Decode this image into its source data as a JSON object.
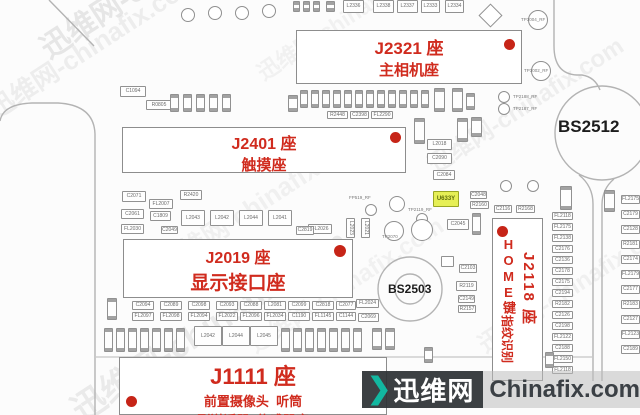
{
  "board": {
    "accent_red": "#d02b1e",
    "highlight_color": "#e6ef56",
    "connectors": {
      "j2321": {
        "title": "J2321 座",
        "subtitle": "主相机座"
      },
      "j2401": {
        "title": "J2401 座",
        "subtitle": "触摸座"
      },
      "j2019": {
        "title": "J2019 座",
        "subtitle": "显示接口座"
      },
      "j1111": {
        "title": "J1111 座",
        "line1": "前置摄像头  听筒",
        "line2": "副送话器  传感器座"
      },
      "j2118": {
        "title": "J2118 座",
        "home": "HOME键",
        "fingerprint": "指纹识别"
      }
    },
    "screws": {
      "bs2512": "BS2512",
      "bs2503": "BS2503"
    },
    "components": [
      {
        "l": "",
        "x": 293,
        "y": 1,
        "w": 7,
        "h": 11,
        "v": 1
      },
      {
        "l": "",
        "x": 303,
        "y": 1,
        "w": 7,
        "h": 11,
        "v": 1
      },
      {
        "l": "",
        "x": 313,
        "y": 1,
        "w": 7,
        "h": 11,
        "v": 1
      },
      {
        "l": "",
        "x": 326,
        "y": 1,
        "w": 9,
        "h": 11,
        "v": 1
      },
      {
        "l": "L2336",
        "x": 343,
        "y": 0,
        "w": 21,
        "h": 13
      },
      {
        "l": "L2338",
        "x": 373,
        "y": 0,
        "w": 21,
        "h": 13
      },
      {
        "l": "L2337",
        "x": 397,
        "y": 0,
        "w": 21,
        "h": 13
      },
      {
        "l": "L2333",
        "x": 421,
        "y": 0,
        "w": 19,
        "h": 13
      },
      {
        "l": "L2334",
        "x": 445,
        "y": 0,
        "w": 19,
        "h": 13
      },
      {
        "l": "C1094",
        "x": 120,
        "y": 86,
        "w": 26,
        "h": 11
      },
      {
        "l": "R0805",
        "x": 146,
        "y": 100,
        "w": 26,
        "h": 10
      },
      {
        "l": "",
        "x": 170,
        "y": 94,
        "w": 9,
        "h": 18,
        "v": 1
      },
      {
        "l": "",
        "x": 183,
        "y": 94,
        "w": 9,
        "h": 18,
        "v": 1
      },
      {
        "l": "",
        "x": 196,
        "y": 94,
        "w": 9,
        "h": 18,
        "v": 1
      },
      {
        "l": "",
        "x": 209,
        "y": 94,
        "w": 9,
        "h": 18,
        "v": 1
      },
      {
        "l": "",
        "x": 222,
        "y": 94,
        "w": 9,
        "h": 18,
        "v": 1
      },
      {
        "l": "",
        "x": 288,
        "y": 95,
        "w": 10,
        "h": 17,
        "v": 1
      },
      {
        "l": "",
        "x": 300,
        "y": 90,
        "w": 8,
        "h": 18,
        "v": 1
      },
      {
        "l": "",
        "x": 311,
        "y": 90,
        "w": 8,
        "h": 18,
        "v": 1
      },
      {
        "l": "",
        "x": 322,
        "y": 90,
        "w": 8,
        "h": 18,
        "v": 1
      },
      {
        "l": "",
        "x": 333,
        "y": 90,
        "w": 8,
        "h": 18,
        "v": 1
      },
      {
        "l": "",
        "x": 344,
        "y": 90,
        "w": 8,
        "h": 18,
        "v": 1
      },
      {
        "l": "",
        "x": 355,
        "y": 90,
        "w": 8,
        "h": 18,
        "v": 1
      },
      {
        "l": "",
        "x": 366,
        "y": 90,
        "w": 8,
        "h": 18,
        "v": 1
      },
      {
        "l": "",
        "x": 377,
        "y": 90,
        "w": 8,
        "h": 18,
        "v": 1
      },
      {
        "l": "",
        "x": 388,
        "y": 90,
        "w": 8,
        "h": 18,
        "v": 1
      },
      {
        "l": "",
        "x": 399,
        "y": 90,
        "w": 8,
        "h": 18,
        "v": 1
      },
      {
        "l": "",
        "x": 410,
        "y": 90,
        "w": 8,
        "h": 18,
        "v": 1
      },
      {
        "l": "",
        "x": 421,
        "y": 90,
        "w": 8,
        "h": 18,
        "v": 1
      },
      {
        "l": "",
        "x": 434,
        "y": 88,
        "w": 11,
        "h": 24,
        "v": 1
      },
      {
        "l": "",
        "x": 452,
        "y": 88,
        "w": 11,
        "h": 24,
        "v": 1
      },
      {
        "l": "",
        "x": 466,
        "y": 93,
        "w": 9,
        "h": 17,
        "v": 1
      },
      {
        "l": "R2448",
        "x": 327,
        "y": 111,
        "w": 21,
        "h": 8
      },
      {
        "l": "C2398",
        "x": 350,
        "y": 111,
        "w": 19,
        "h": 8
      },
      {
        "l": "FL2290",
        "x": 371,
        "y": 111,
        "w": 22,
        "h": 8
      },
      {
        "l": "",
        "x": 414,
        "y": 118,
        "w": 11,
        "h": 26,
        "v": 1
      },
      {
        "l": "",
        "x": 457,
        "y": 118,
        "w": 11,
        "h": 24,
        "v": 1
      },
      {
        "l": "",
        "x": 471,
        "y": 117,
        "w": 11,
        "h": 20,
        "v": 1
      },
      {
        "l": "L2018",
        "x": 427,
        "y": 139,
        "w": 25,
        "h": 11
      },
      {
        "l": "C2090",
        "x": 427,
        "y": 153,
        "w": 25,
        "h": 11
      },
      {
        "l": "C2084",
        "x": 433,
        "y": 170,
        "w": 22,
        "h": 10
      },
      {
        "l": "U633Y",
        "x": 433,
        "y": 191,
        "w": 26,
        "h": 16,
        "hl": 1
      },
      {
        "l": "C2045",
        "x": 447,
        "y": 219,
        "w": 22,
        "h": 11
      },
      {
        "l": "",
        "x": 472,
        "y": 213,
        "w": 9,
        "h": 22,
        "v": 1
      },
      {
        "l": "C2048",
        "x": 470,
        "y": 191,
        "w": 17,
        "h": 8
      },
      {
        "l": "R2160",
        "x": 470,
        "y": 201,
        "w": 19,
        "h": 8
      },
      {
        "l": "C2116",
        "x": 494,
        "y": 205,
        "w": 18,
        "h": 8
      },
      {
        "l": "R2168",
        "x": 516,
        "y": 205,
        "w": 19,
        "h": 8
      },
      {
        "l": "C2103",
        "x": 459,
        "y": 264,
        "w": 18,
        "h": 9
      },
      {
        "l": "R2119",
        "x": 456,
        "y": 281,
        "w": 21,
        "h": 10
      },
      {
        "l": "C2149",
        "x": 458,
        "y": 295,
        "w": 17,
        "h": 8
      },
      {
        "l": "R2157",
        "x": 458,
        "y": 305,
        "w": 18,
        "h": 8
      },
      {
        "l": "",
        "x": 441,
        "y": 256,
        "w": 13,
        "h": 11
      },
      {
        "l": "FL2026",
        "x": 308,
        "y": 224,
        "w": 24,
        "h": 10
      },
      {
        "l": "L2023",
        "x": 346,
        "y": 218,
        "w": 9,
        "h": 20,
        "v": 1
      },
      {
        "l": "L2021",
        "x": 361,
        "y": 218,
        "w": 9,
        "h": 20,
        "v": 1
      },
      {
        "l": "C2071",
        "x": 122,
        "y": 191,
        "w": 24,
        "h": 11
      },
      {
        "l": "R2420",
        "x": 180,
        "y": 190,
        "w": 22,
        "h": 10
      },
      {
        "l": "FL2007",
        "x": 149,
        "y": 199,
        "w": 24,
        "h": 10
      },
      {
        "l": "C2061",
        "x": 121,
        "y": 209,
        "w": 23,
        "h": 10
      },
      {
        "l": "C1809",
        "x": 150,
        "y": 211,
        "w": 21,
        "h": 10
      },
      {
        "l": "FL2030",
        "x": 121,
        "y": 224,
        "w": 23,
        "h": 10
      },
      {
        "l": "C2049",
        "x": 161,
        "y": 226,
        "w": 17,
        "h": 8
      },
      {
        "l": "L2043",
        "x": 181,
        "y": 210,
        "w": 24,
        "h": 16
      },
      {
        "l": "L2042",
        "x": 210,
        "y": 210,
        "w": 24,
        "h": 16
      },
      {
        "l": "L2044",
        "x": 239,
        "y": 210,
        "w": 24,
        "h": 16
      },
      {
        "l": "L2041",
        "x": 268,
        "y": 210,
        "w": 24,
        "h": 16
      },
      {
        "l": "C2819",
        "x": 296,
        "y": 226,
        "w": 18,
        "h": 9
      },
      {
        "l": "FL2118",
        "x": 552,
        "y": 212,
        "w": 21,
        "h": 8
      },
      {
        "l": "FL2175",
        "x": 552,
        "y": 223,
        "w": 21,
        "h": 8
      },
      {
        "l": "FL2138",
        "x": 552,
        "y": 234,
        "w": 21,
        "h": 8
      },
      {
        "l": "C2176",
        "x": 552,
        "y": 245,
        "w": 21,
        "h": 8
      },
      {
        "l": "C2136",
        "x": 552,
        "y": 256,
        "w": 21,
        "h": 8
      },
      {
        "l": "C2178",
        "x": 552,
        "y": 267,
        "w": 21,
        "h": 8
      },
      {
        "l": "C2175",
        "x": 552,
        "y": 278,
        "w": 21,
        "h": 8
      },
      {
        "l": "C2194",
        "x": 552,
        "y": 289,
        "w": 21,
        "h": 8
      },
      {
        "l": "R2182",
        "x": 552,
        "y": 300,
        "w": 21,
        "h": 8
      },
      {
        "l": "C2126",
        "x": 552,
        "y": 311,
        "w": 21,
        "h": 8
      },
      {
        "l": "C2198",
        "x": 552,
        "y": 322,
        "w": 21,
        "h": 8
      },
      {
        "l": "FL2122",
        "x": 552,
        "y": 333,
        "w": 21,
        "h": 8
      },
      {
        "l": "C2188",
        "x": 552,
        "y": 344,
        "w": 21,
        "h": 8
      },
      {
        "l": "FL2150",
        "x": 552,
        "y": 355,
        "w": 21,
        "h": 8
      },
      {
        "l": "FL2118",
        "x": 552,
        "y": 366,
        "w": 21,
        "h": 8
      },
      {
        "l": "",
        "x": 560,
        "y": 186,
        "w": 12,
        "h": 24,
        "v": 1
      },
      {
        "l": "",
        "x": 604,
        "y": 190,
        "w": 11,
        "h": 22,
        "v": 1
      },
      {
        "l": "FL2175",
        "x": 621,
        "y": 195,
        "w": 19,
        "h": 9
      },
      {
        "l": "C2179",
        "x": 621,
        "y": 210,
        "w": 19,
        "h": 9
      },
      {
        "l": "C2128",
        "x": 621,
        "y": 225,
        "w": 19,
        "h": 9
      },
      {
        "l": "R2181",
        "x": 621,
        "y": 240,
        "w": 19,
        "h": 9
      },
      {
        "l": "C2174",
        "x": 621,
        "y": 255,
        "w": 19,
        "h": 9
      },
      {
        "l": "FL2179",
        "x": 621,
        "y": 270,
        "w": 19,
        "h": 9
      },
      {
        "l": "C2177",
        "x": 621,
        "y": 285,
        "w": 19,
        "h": 9
      },
      {
        "l": "R2183",
        "x": 621,
        "y": 300,
        "w": 19,
        "h": 9
      },
      {
        "l": "C2127",
        "x": 621,
        "y": 315,
        "w": 19,
        "h": 9
      },
      {
        "l": "FL2123",
        "x": 621,
        "y": 330,
        "w": 19,
        "h": 9
      },
      {
        "l": "C2189",
        "x": 621,
        "y": 345,
        "w": 19,
        "h": 9
      },
      {
        "l": "",
        "x": 107,
        "y": 298,
        "w": 10,
        "h": 22,
        "v": 1
      },
      {
        "l": "C2094",
        "x": 132,
        "y": 301,
        "w": 22,
        "h": 9
      },
      {
        "l": "FL2097",
        "x": 132,
        "y": 312,
        "w": 22,
        "h": 9
      },
      {
        "l": "C2089",
        "x": 160,
        "y": 301,
        "w": 22,
        "h": 9
      },
      {
        "l": "FL2098",
        "x": 160,
        "y": 312,
        "w": 22,
        "h": 9
      },
      {
        "l": "C2098",
        "x": 188,
        "y": 301,
        "w": 22,
        "h": 9
      },
      {
        "l": "FL2094",
        "x": 188,
        "y": 312,
        "w": 22,
        "h": 9
      },
      {
        "l": "C2093",
        "x": 216,
        "y": 301,
        "w": 22,
        "h": 9
      },
      {
        "l": "FL2022",
        "x": 216,
        "y": 312,
        "w": 22,
        "h": 9
      },
      {
        "l": "C2088",
        "x": 240,
        "y": 301,
        "w": 22,
        "h": 9
      },
      {
        "l": "FL2096",
        "x": 240,
        "y": 312,
        "w": 22,
        "h": 9
      },
      {
        "l": "L2081",
        "x": 264,
        "y": 301,
        "w": 22,
        "h": 9
      },
      {
        "l": "FL2034",
        "x": 264,
        "y": 312,
        "w": 22,
        "h": 9
      },
      {
        "l": "C2099",
        "x": 288,
        "y": 301,
        "w": 22,
        "h": 9
      },
      {
        "l": "C1190",
        "x": 288,
        "y": 312,
        "w": 22,
        "h": 9
      },
      {
        "l": "C2818",
        "x": 312,
        "y": 301,
        "w": 22,
        "h": 9
      },
      {
        "l": "FL1145",
        "x": 312,
        "y": 312,
        "w": 22,
        "h": 9
      },
      {
        "l": "C2077",
        "x": 336,
        "y": 301,
        "w": 20,
        "h": 9
      },
      {
        "l": "C1144",
        "x": 336,
        "y": 312,
        "w": 20,
        "h": 9
      },
      {
        "l": "FL2024",
        "x": 356,
        "y": 299,
        "w": 23,
        "h": 9
      },
      {
        "l": "C2069",
        "x": 358,
        "y": 313,
        "w": 21,
        "h": 9
      },
      {
        "l": "",
        "x": 104,
        "y": 328,
        "w": 9,
        "h": 24,
        "v": 1
      },
      {
        "l": "",
        "x": 116,
        "y": 328,
        "w": 9,
        "h": 24,
        "v": 1
      },
      {
        "l": "",
        "x": 128,
        "y": 328,
        "w": 9,
        "h": 24,
        "v": 1
      },
      {
        "l": "",
        "x": 140,
        "y": 328,
        "w": 9,
        "h": 24,
        "v": 1
      },
      {
        "l": "",
        "x": 152,
        "y": 328,
        "w": 9,
        "h": 24,
        "v": 1
      },
      {
        "l": "",
        "x": 164,
        "y": 328,
        "w": 9,
        "h": 24,
        "v": 1
      },
      {
        "l": "",
        "x": 176,
        "y": 328,
        "w": 9,
        "h": 24,
        "v": 1
      },
      {
        "l": "L2042",
        "x": 194,
        "y": 326,
        "w": 28,
        "h": 20
      },
      {
        "l": "L2044",
        "x": 222,
        "y": 326,
        "w": 28,
        "h": 20
      },
      {
        "l": "L2045",
        "x": 250,
        "y": 326,
        "w": 28,
        "h": 20
      },
      {
        "l": "",
        "x": 281,
        "y": 328,
        "w": 9,
        "h": 24,
        "v": 1
      },
      {
        "l": "",
        "x": 293,
        "y": 328,
        "w": 9,
        "h": 24,
        "v": 1
      },
      {
        "l": "",
        "x": 305,
        "y": 328,
        "w": 9,
        "h": 24,
        "v": 1
      },
      {
        "l": "",
        "x": 317,
        "y": 328,
        "w": 9,
        "h": 24,
        "v": 1
      },
      {
        "l": "",
        "x": 329,
        "y": 328,
        "w": 9,
        "h": 24,
        "v": 1
      },
      {
        "l": "",
        "x": 341,
        "y": 328,
        "w": 9,
        "h": 24,
        "v": 1
      },
      {
        "l": "",
        "x": 353,
        "y": 328,
        "w": 9,
        "h": 24,
        "v": 1
      },
      {
        "l": "",
        "x": 372,
        "y": 328,
        "w": 10,
        "h": 22,
        "v": 1
      },
      {
        "l": "",
        "x": 385,
        "y": 328,
        "w": 10,
        "h": 22,
        "v": 1
      },
      {
        "l": "",
        "x": 424,
        "y": 347,
        "w": 9,
        "h": 16,
        "v": 1
      },
      {
        "l": "",
        "x": 545,
        "y": 352,
        "w": 9,
        "h": 16,
        "v": 1
      }
    ],
    "testpoints": [
      {
        "l": "TP3004_RF",
        "x": 538,
        "y": 20,
        "r": 10,
        "lx": 521,
        "ly": 17
      },
      {
        "l": "TP3002_RF",
        "x": 541,
        "y": 71,
        "r": 10,
        "lx": 524,
        "ly": 68
      },
      {
        "l": "TP2198_RF",
        "x": 462,
        "y": 58,
        "r": 5,
        "lx": 470,
        "ly": 55
      },
      {
        "l": "TP2199_RF",
        "x": 477,
        "y": 67,
        "r": 4,
        "sq": 1,
        "lx": 486,
        "ly": 64
      },
      {
        "l": "TP2188_RF",
        "x": 504,
        "y": 97,
        "r": 6,
        "lx": 513,
        "ly": 94
      },
      {
        "l": "TP2187_RF",
        "x": 504,
        "y": 109,
        "r": 6,
        "lx": 513,
        "ly": 106
      },
      {
        "l": "FP519_RF",
        "x": 371,
        "y": 210,
        "r": 6,
        "lx": 349,
        "ly": 195
      },
      {
        "l": "TP2119_RF",
        "x": 422,
        "y": 219,
        "r": 6,
        "lx": 408,
        "ly": 207
      },
      {
        "l": "",
        "x": 397,
        "y": 204,
        "r": 8
      },
      {
        "l": "TP2070",
        "x": 394,
        "y": 231,
        "r": 10,
        "lx": 382,
        "ly": 234
      },
      {
        "l": "",
        "x": 422,
        "y": 230,
        "r": 11
      },
      {
        "l": "",
        "x": 506,
        "y": 186,
        "r": 6
      },
      {
        "l": "",
        "x": 533,
        "y": 186,
        "r": 6
      },
      {
        "l": "",
        "x": 188,
        "y": 15,
        "r": 7
      },
      {
        "l": "",
        "x": 215,
        "y": 13,
        "r": 7
      },
      {
        "l": "",
        "x": 242,
        "y": 13,
        "r": 7
      },
      {
        "l": "",
        "x": 269,
        "y": 11,
        "r": 7
      }
    ]
  },
  "watermark": {
    "texture_text": "迅维网-chinafix.com",
    "chevron": "❯",
    "site_cn": "迅维网",
    "site_en": "Chinafix.com",
    "chevron_color": "#12b7a0"
  }
}
